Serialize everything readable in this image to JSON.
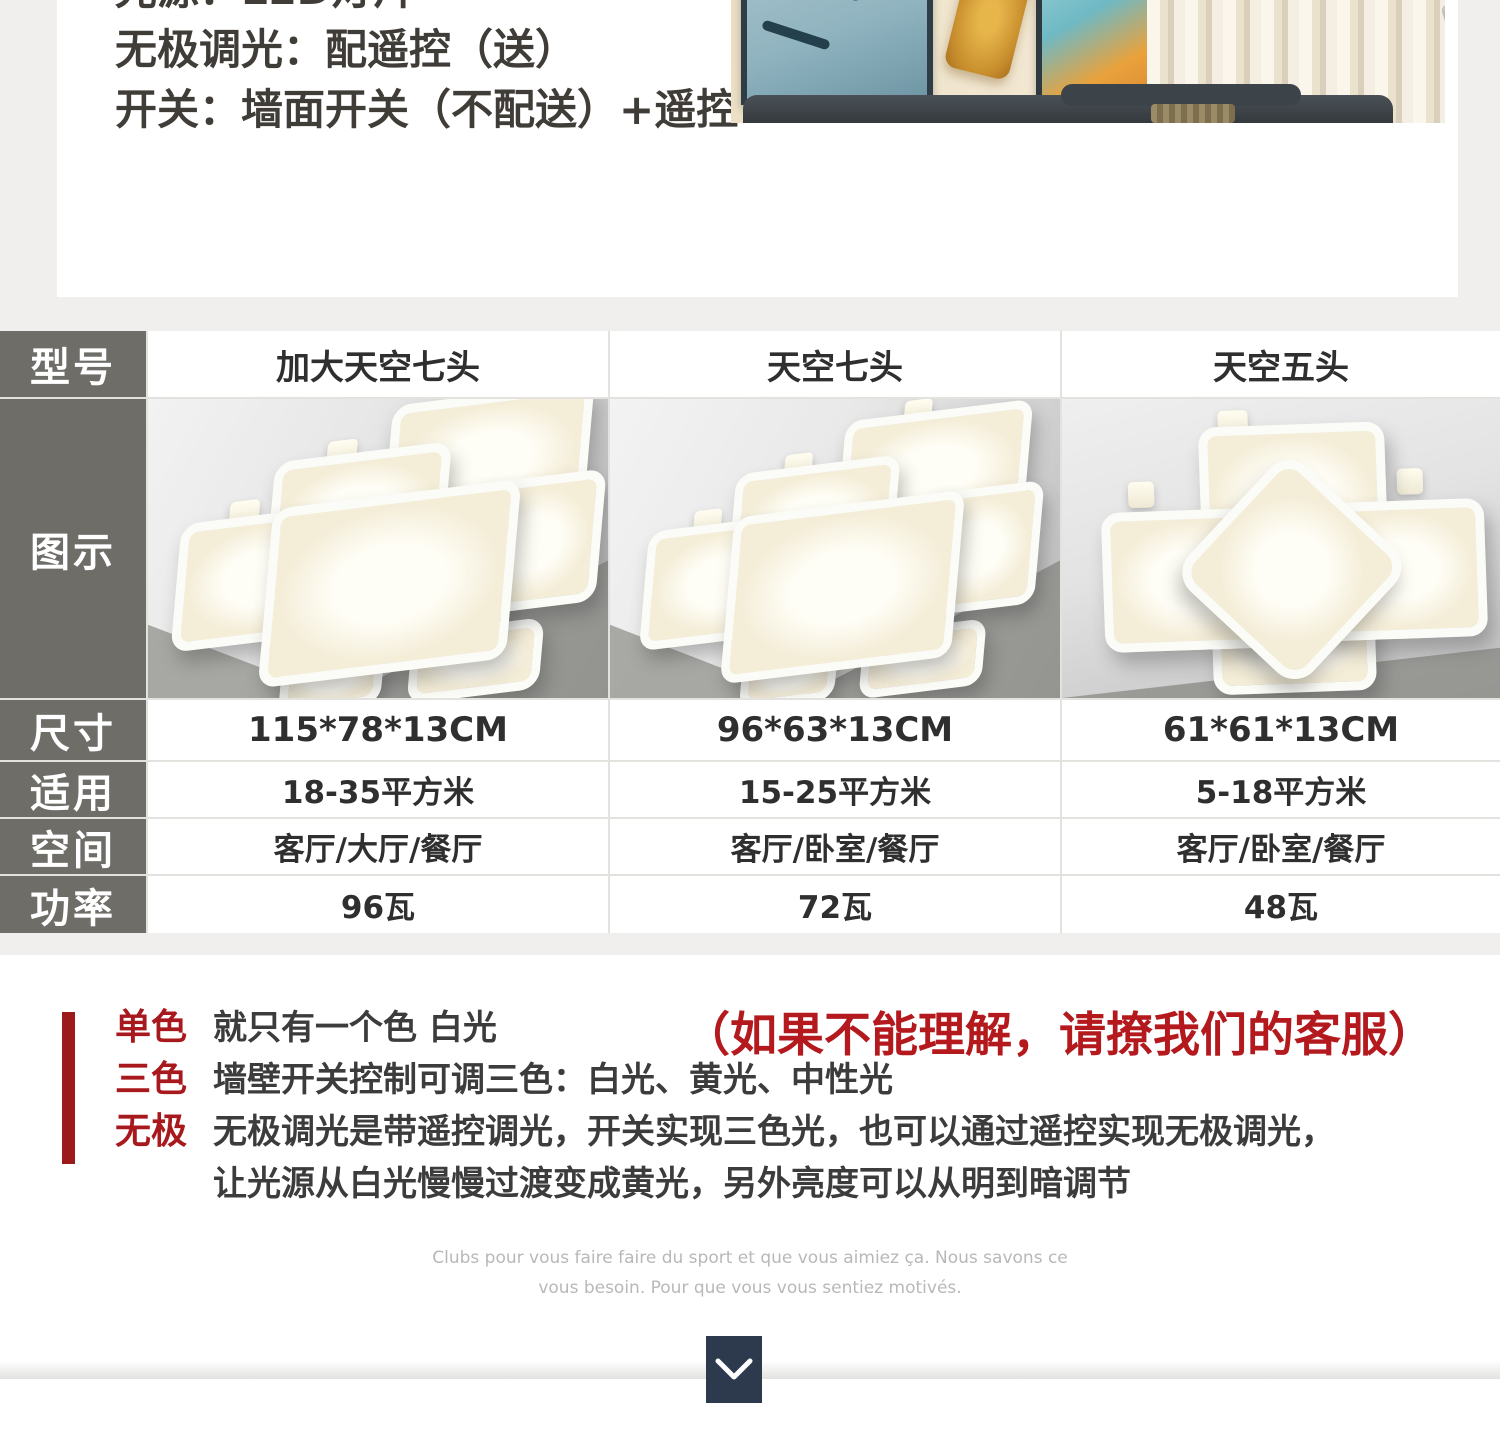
{
  "colors": {
    "accent_red": "#b3191d",
    "label_red": "#a8191d",
    "table_header_gray": "#6e6d68",
    "button_navy": "#2d3a4e",
    "page_bg": "#f0efed"
  },
  "top": {
    "line1": "光源：LED灯片",
    "line2": "无极调光：配遥控（送）",
    "line3": "开关：墙面开关（不配送）+遥控"
  },
  "table": {
    "row_headers": [
      "型号",
      "图示",
      "尺寸",
      "适用",
      "空间",
      "功率"
    ],
    "models": [
      {
        "name": "加大天空七头",
        "size": "115*78*13CM",
        "area": "18-35平方米",
        "rooms": "客厅/大厅/餐厅",
        "power": "96瓦"
      },
      {
        "name": "天空七头",
        "size": "96*63*13CM",
        "area": "15-25平方米",
        "rooms": "客厅/卧室/餐厅",
        "power": "72瓦"
      },
      {
        "name": "天空五头",
        "size": "61*61*13CM",
        "area": "5-18平方米",
        "rooms": "客厅/卧室/餐厅",
        "power": "48瓦"
      }
    ]
  },
  "notes": {
    "headline": "（如果不能理解，请撩我们的客服）",
    "items": [
      {
        "label": "单色",
        "text": "就只有一个色 白光"
      },
      {
        "label": "三色",
        "text": "墙壁开关控制可调三色：白光、黄光、中性光"
      },
      {
        "label": "无极",
        "text": "无极调光是带遥控调光，开关实现三色光，也可以通过遥控实现无极调光，",
        "text2": "让光源从白光慢慢过渡变成黄光，另外亮度可以从明到暗调节"
      }
    ]
  },
  "footer": {
    "fr_line1": "Clubs pour vous faire faire du sport et que vous aimiez ça. Nous savons ce",
    "fr_line2": "vous besoin. Pour que vous vous sentiez motivés.",
    "expand_icon": "chevron-down-icon"
  }
}
